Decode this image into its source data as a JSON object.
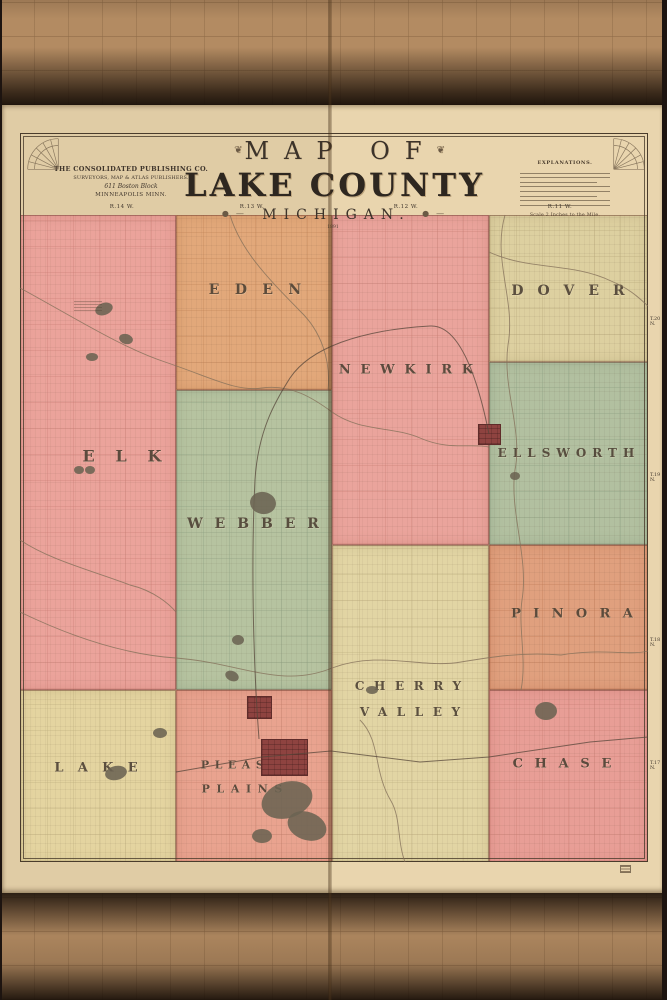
{
  "sheet": {
    "publisher": {
      "line1": "THE CONSOLIDATED PUBLISHING CO.",
      "line2": "SURVEYORS, MAP & ATLAS PUBLISHERS.",
      "line3": "611 Boston Block",
      "line4": "MINNEAPOLIS MINN."
    },
    "title": {
      "line1": "MAP OF",
      "line2": "LAKE COUNTY",
      "line3": "MICHIGAN.",
      "year": "1891",
      "flourish": "❦",
      "ornament": "●—"
    },
    "legend": {
      "heading": "EXPLANATIONS.",
      "scale_note": "Scale 2 Inches to the Mile.",
      "line_count": 8
    },
    "range_labels": [
      {
        "text": "R.14 W.",
        "cx": 122
      },
      {
        "text": "R.13 W.",
        "cx": 252
      },
      {
        "text": "R.12 W.",
        "cx": 406
      },
      {
        "text": "R.11 W.",
        "cx": 560
      }
    ],
    "town_labels": [
      {
        "text": "T.20 N.",
        "cy": 322
      },
      {
        "text": "T.19 N.",
        "cy": 478
      },
      {
        "text": "T.18 N.",
        "cy": 643
      },
      {
        "text": "T.17 N.",
        "cy": 766
      }
    ]
  },
  "map": {
    "townships": [
      {
        "id": "elk",
        "name": "ELK",
        "fill": "#eba39b",
        "grid": "#c5796f",
        "x": 20,
        "y": 215,
        "w": 156,
        "h": 475,
        "cell": 26,
        "labels": [
          {
            "text": "ELK",
            "cx": 122,
            "cy": 456,
            "size": 16,
            "ls": 1.3
          }
        ]
      },
      {
        "id": "eden",
        "name": "EDEN",
        "fill": "#e2a87a",
        "grid": "#bd7f52",
        "x": 176,
        "y": 215,
        "w": 156,
        "h": 175,
        "cell": 26,
        "labels": [
          {
            "text": "EDEN",
            "cx": 255,
            "cy": 290,
            "size": 14,
            "ls": 1.1
          }
        ]
      },
      {
        "id": "newkirk",
        "name": "NEWKIRK",
        "fill": "#eaa49c",
        "grid": "#c5796f",
        "x": 332,
        "y": 215,
        "w": 157,
        "h": 330,
        "cell": 26,
        "labels": [
          {
            "text": "NEWKIRK",
            "cx": 406,
            "cy": 370,
            "size": 13,
            "ls": 0.75
          }
        ]
      },
      {
        "id": "dover",
        "name": "DOVER",
        "fill": "#ddd0a0",
        "grid": "#b3a375",
        "x": 489,
        "y": 215,
        "w": 159,
        "h": 147,
        "cell": 26,
        "labels": [
          {
            "text": "DOVER",
            "cx": 568,
            "cy": 291,
            "size": 14,
            "ls": 1.0
          }
        ]
      },
      {
        "id": "ellsworth",
        "name": "ELLSWORTH",
        "fill": "#b2c0a0",
        "grid": "#85997c",
        "x": 489,
        "y": 362,
        "w": 159,
        "h": 183,
        "cell": 26,
        "labels": [
          {
            "text": "ELLSWORTH",
            "cx": 566,
            "cy": 453,
            "size": 12,
            "ls": 0.5
          }
        ]
      },
      {
        "id": "webber",
        "name": "WEBBER",
        "fill": "#b6c3a0",
        "grid": "#85997c",
        "x": 176,
        "y": 390,
        "w": 156,
        "h": 300,
        "cell": 26,
        "labels": [
          {
            "text": "WEBBER",
            "cx": 253,
            "cy": 524,
            "size": 14,
            "ls": 0.85
          }
        ]
      },
      {
        "id": "pinora",
        "name": "PINORA",
        "fill": "#e0a07e",
        "grid": "#bb7451",
        "x": 489,
        "y": 545,
        "w": 159,
        "h": 145,
        "cell": 26,
        "labels": [
          {
            "text": "PINORA",
            "cx": 572,
            "cy": 614,
            "size": 13,
            "ls": 0.95
          }
        ]
      },
      {
        "id": "cherry-valley",
        "name": "CHERRY VALLEY",
        "fill": "#e2d5a4",
        "grid": "#b8a878",
        "x": 332,
        "y": 545,
        "w": 157,
        "h": 317,
        "cell": 26,
        "labels": [
          {
            "text": "CHERRY",
            "cx": 408,
            "cy": 686,
            "size": 12,
            "ls": 0.8
          },
          {
            "text": "VALLEY",
            "cx": 410,
            "cy": 712,
            "size": 12,
            "ls": 0.8
          }
        ]
      },
      {
        "id": "lake",
        "name": "LAKE",
        "fill": "#e4d4a0",
        "grid": "#b8a878",
        "x": 20,
        "y": 690,
        "w": 156,
        "h": 172,
        "cell": 26,
        "labels": [
          {
            "text": "LAKE",
            "cx": 96,
            "cy": 768,
            "size": 13,
            "ls": 1.1
          }
        ]
      },
      {
        "id": "pleasant-plains",
        "name": "PLEASANT PLAINS",
        "fill": "#e9a38f",
        "grid": "#c27a66",
        "x": 176,
        "y": 690,
        "w": 156,
        "h": 172,
        "cell": 26,
        "labels": [
          {
            "text": "PLEASANT",
            "cx": 254,
            "cy": 765,
            "size": 11,
            "ls": 0.5
          },
          {
            "text": "PLAINS",
            "cx": 242,
            "cy": 789,
            "size": 11,
            "ls": 0.6
          }
        ]
      },
      {
        "id": "chase",
        "name": "CHASE",
        "fill": "#e89e96",
        "grid": "#c5796f",
        "x": 489,
        "y": 690,
        "w": 159,
        "h": 172,
        "cell": 26,
        "labels": [
          {
            "text": "CHASE",
            "cx": 562,
            "cy": 764,
            "size": 13,
            "ls": 0.9
          }
        ]
      }
    ],
    "village_color": "#8e4340",
    "villages": [
      {
        "x": 478,
        "y": 424,
        "w": 23,
        "h": 21
      },
      {
        "x": 247,
        "y": 696,
        "w": 25,
        "h": 23
      },
      {
        "x": 261,
        "y": 739,
        "w": 47,
        "h": 37
      }
    ],
    "lake_color": "#6b6352",
    "lakes": [
      {
        "cx": 104,
        "cy": 309,
        "rx": 9,
        "ry": 6,
        "rot": -20
      },
      {
        "cx": 126,
        "cy": 339,
        "rx": 7,
        "ry": 5,
        "rot": 15
      },
      {
        "cx": 92,
        "cy": 357,
        "rx": 6,
        "ry": 4,
        "rot": 0
      },
      {
        "cx": 79,
        "cy": 470,
        "rx": 5,
        "ry": 4,
        "rot": 0
      },
      {
        "cx": 90,
        "cy": 470,
        "rx": 5,
        "ry": 4,
        "rot": 0
      },
      {
        "cx": 263,
        "cy": 503,
        "rx": 13,
        "ry": 11,
        "rot": 10
      },
      {
        "cx": 238,
        "cy": 640,
        "rx": 6,
        "ry": 5,
        "rot": 0
      },
      {
        "cx": 232,
        "cy": 676,
        "rx": 7,
        "ry": 5,
        "rot": 25
      },
      {
        "cx": 160,
        "cy": 733,
        "rx": 7,
        "ry": 5,
        "rot": 0
      },
      {
        "cx": 116,
        "cy": 773,
        "rx": 11,
        "ry": 7,
        "rot": -12
      },
      {
        "cx": 287,
        "cy": 800,
        "rx": 26,
        "ry": 18,
        "rot": -18
      },
      {
        "cx": 307,
        "cy": 826,
        "rx": 20,
        "ry": 14,
        "rot": 20
      },
      {
        "cx": 262,
        "cy": 836,
        "rx": 10,
        "ry": 7,
        "rot": 0
      },
      {
        "cx": 546,
        "cy": 711,
        "rx": 11,
        "ry": 9,
        "rot": 0
      },
      {
        "cx": 515,
        "cy": 476,
        "rx": 5,
        "ry": 4,
        "rot": 0
      },
      {
        "cx": 372,
        "cy": 690,
        "rx": 6,
        "ry": 4,
        "rot": 0
      }
    ],
    "stream_color": "#84705a",
    "streams": [
      {
        "d": "M20,288 C70,315 122,348 165,362 C210,377 236,392 262,388 C291,384 313,398 332,412 C360,432 392,426 420,438 C450,451 470,443 489,447"
      },
      {
        "d": "M505,215 C492,260 516,300 508,345 C502,388 523,430 515,470 C509,510 529,558 522,600 C518,628 527,660 521,690"
      },
      {
        "d": "M230,215 C241,252 271,281 300,311 C321,331 331,360 328,390"
      },
      {
        "d": "M489,252 C530,271 571,262 611,281 C631,289 641,300 648,306"
      },
      {
        "d": "M20,612 C80,641 131,655 176,658 C241,663 281,689 332,668 C381,650 421,669 461,662 C491,657 521,652 561,655 C601,648 631,656 648,651"
      },
      {
        "d": "M360,720 C381,741 373,771 391,801 C401,818 397,841 405,862"
      },
      {
        "d": "M20,540 C50,560 90,570 130,585 C155,591 170,605 176,612"
      }
    ],
    "railroad_color": "#55453a",
    "railroads": [
      {
        "d": "M176,772 L262,757 L331,751 L420,762 L489,757 L590,742 L648,737"
      },
      {
        "d": "M259,739 C253,660 251,560 255,480 C258,430 276,400 290,378 C310,348 360,330 430,326 C460,324 478,380 489,434"
      }
    ]
  }
}
